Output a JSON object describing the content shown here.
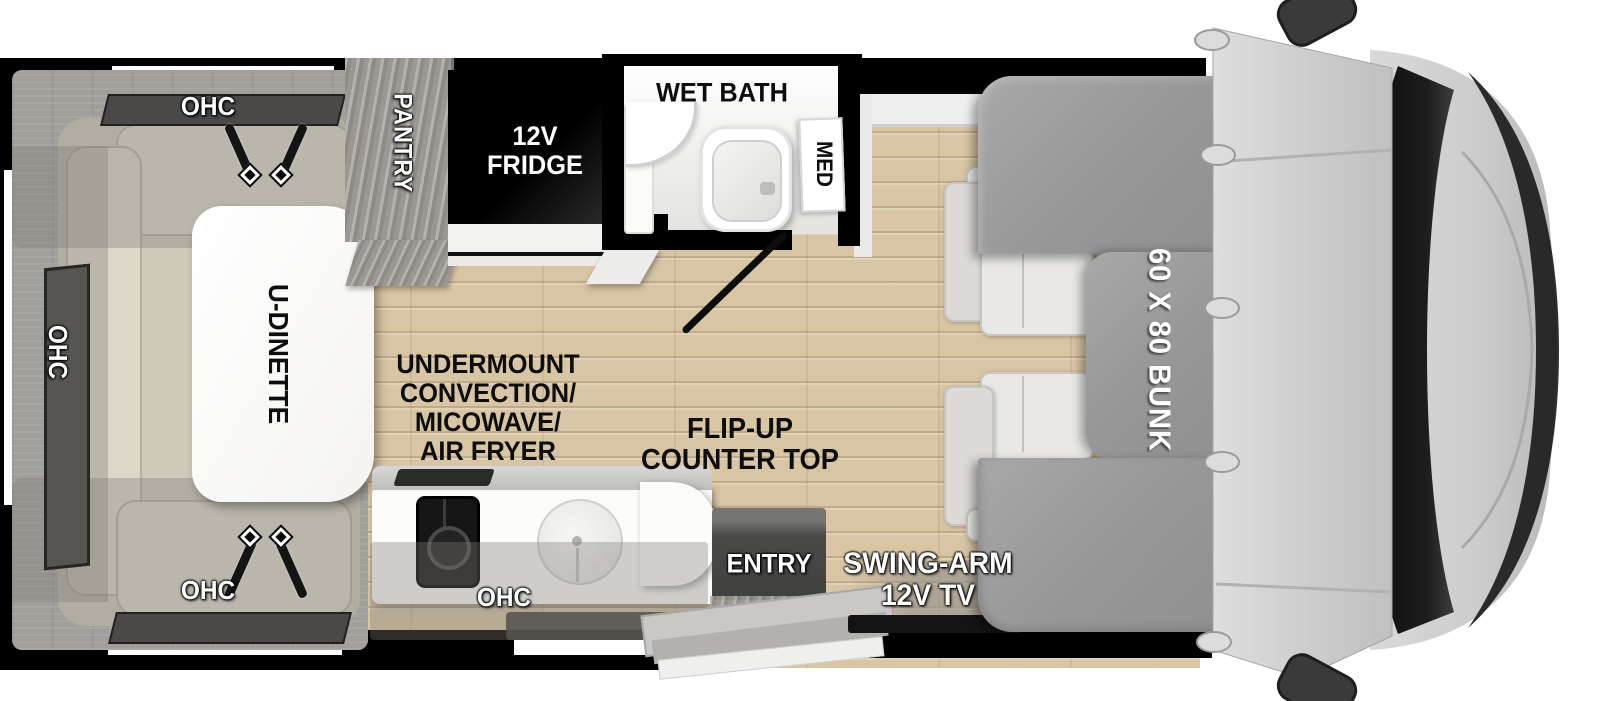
{
  "labels": {
    "ohc": "OHC",
    "pantry": "PANTRY",
    "fridge_line1": "12V",
    "fridge_line2": "FRIDGE",
    "wet_bath": "WET BATH",
    "med": "MED",
    "u_dinette": "U-DINETTE",
    "appliance_line1": "UNDERMOUNT",
    "appliance_line2": "CONVECTION/",
    "appliance_line3": "MICOWAVE/",
    "appliance_line4": "AIR FRYER",
    "flip_line1": "FLIP-UP",
    "flip_line2": "COUNTER TOP",
    "entry": "ENTRY",
    "tv_line1": "SWING-ARM",
    "tv_line2": "12V TV",
    "bunk": "60 X 80 BUNK"
  },
  "colors": {
    "wall": "#000000",
    "floor_wood": "#d8c5a4",
    "bunk_gray": "#9e9e9e",
    "cushion_beige": "#dcd7c9",
    "cab_gray": "#d2d2d2",
    "windshield": "#141414",
    "label_white": "#ffffff",
    "label_black": "#0d0d0d"
  }
}
